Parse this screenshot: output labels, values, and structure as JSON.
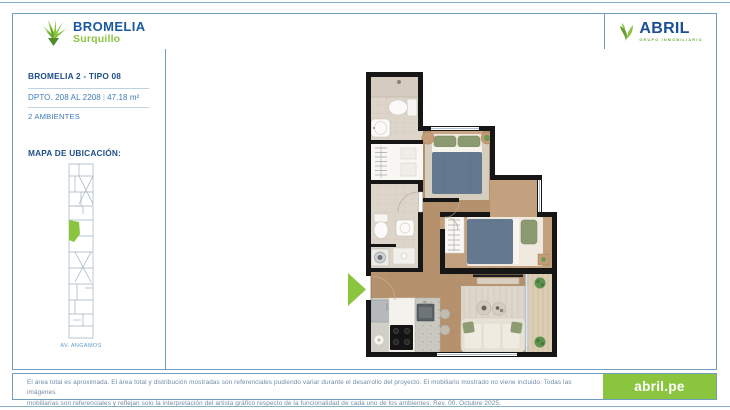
{
  "header": {
    "brand": {
      "name": "BROMELIA",
      "location": "Surquillo"
    },
    "developer": {
      "name": "ABRIL",
      "tagline": "GRUPO INMOBILIARIO"
    }
  },
  "sidebar": {
    "unit_title": "BROMELIA 2 - TIPO 08",
    "unit_line": "DPTO. 208 AL 2208",
    "separator": "|",
    "area": "47.18 m²",
    "rooms": "2 AMBIENTES",
    "map_title": "MAPA DE UBICACIÓN:",
    "map_caption": "AV. ANGAMOS"
  },
  "footer": {
    "disclaimer_line1": "El área total es aproximada. El área total y distribución mostradas son referenciales pudiendo variar durante el desarrollo del proyecto. El mobiliario mostrado no viene incluido. Todas las imágenes",
    "disclaimer_line2": "mobiliarias son referenciales y reflejan solo la interpretación del artista gráfico respecto de la funcionalidad de cada uno de los ambientes. Rev. 00. Octubre 2025.",
    "website": "abril.pe"
  },
  "colors": {
    "navy": "#1b4f96",
    "blue": "#3e7cb8",
    "lime": "#8bc53f",
    "frame": "#6f9fbd",
    "disclaimer_text": "#718ca6"
  }
}
